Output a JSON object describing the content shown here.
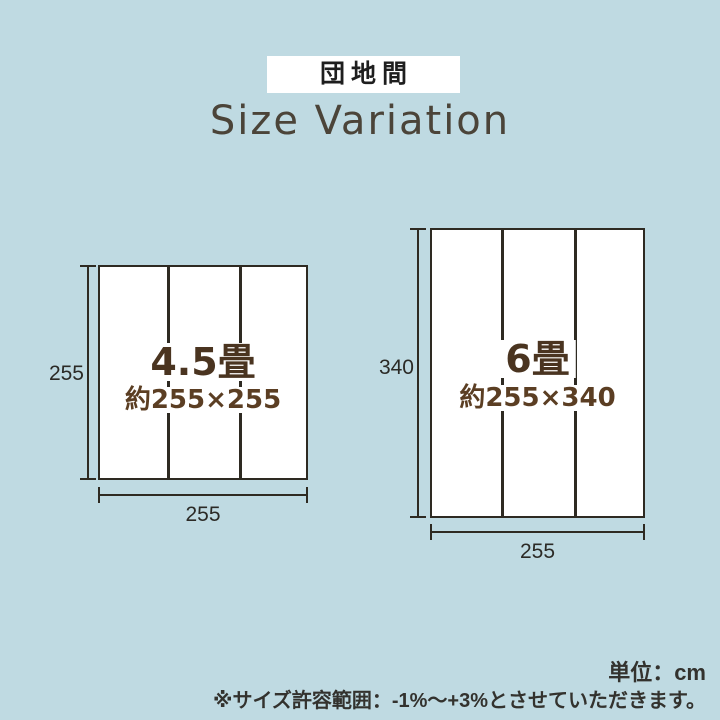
{
  "badge": {
    "label": "団地間"
  },
  "title": "Size Variation",
  "diagrams": {
    "left": {
      "size_label": "4.5畳",
      "dimensions_label": "約255×255",
      "height_value": "255",
      "width_value": "255"
    },
    "right": {
      "size_label": "6畳",
      "dimensions_label": "約255×340",
      "height_value": "340",
      "width_value": "255"
    }
  },
  "notes": {
    "unit_label": "単位：cm",
    "tolerance_note": "※サイズ許容範囲：-1%〜+3%とさせていただきます。"
  },
  "colors": {
    "background": "#bfdae2",
    "line": "#2e2a22",
    "size_label_text": "#4a3420",
    "dimensions_text": "#5b3e23",
    "title_text": "#4b4439",
    "note_text": "#33322e"
  }
}
